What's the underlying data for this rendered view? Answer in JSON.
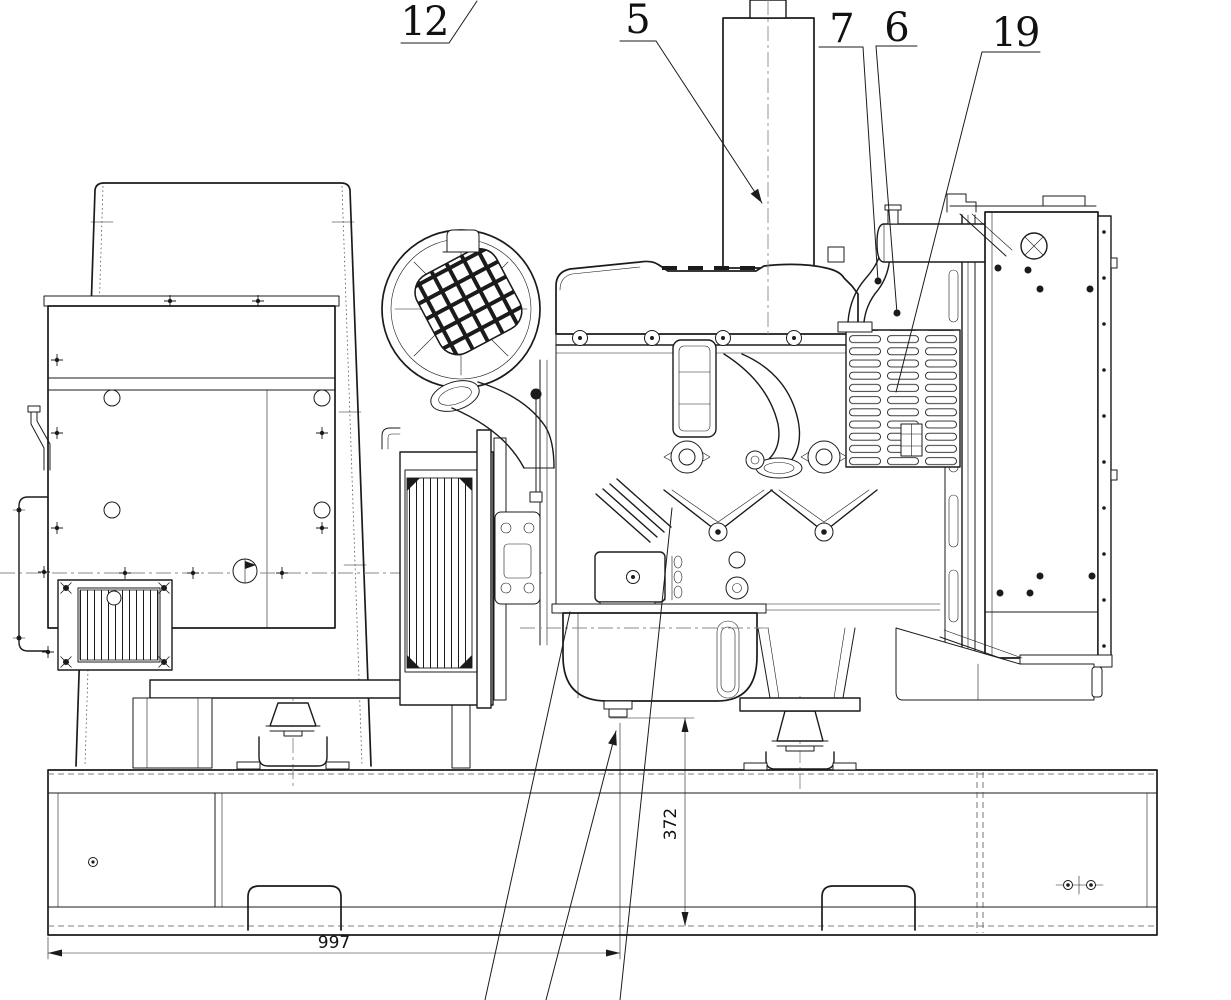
{
  "palette": {
    "background": "#ffffff",
    "ink": "#1b1b1b",
    "centerline": "#8a8a8a"
  },
  "callouts": {
    "c12": {
      "label": "12"
    },
    "c5": {
      "label": "5"
    },
    "c7": {
      "label": "7"
    },
    "c6": {
      "label": "6"
    },
    "c19": {
      "label": "19"
    }
  },
  "dimensions": {
    "horizontal": {
      "value": "997"
    },
    "vertical": {
      "value": "372"
    }
  }
}
